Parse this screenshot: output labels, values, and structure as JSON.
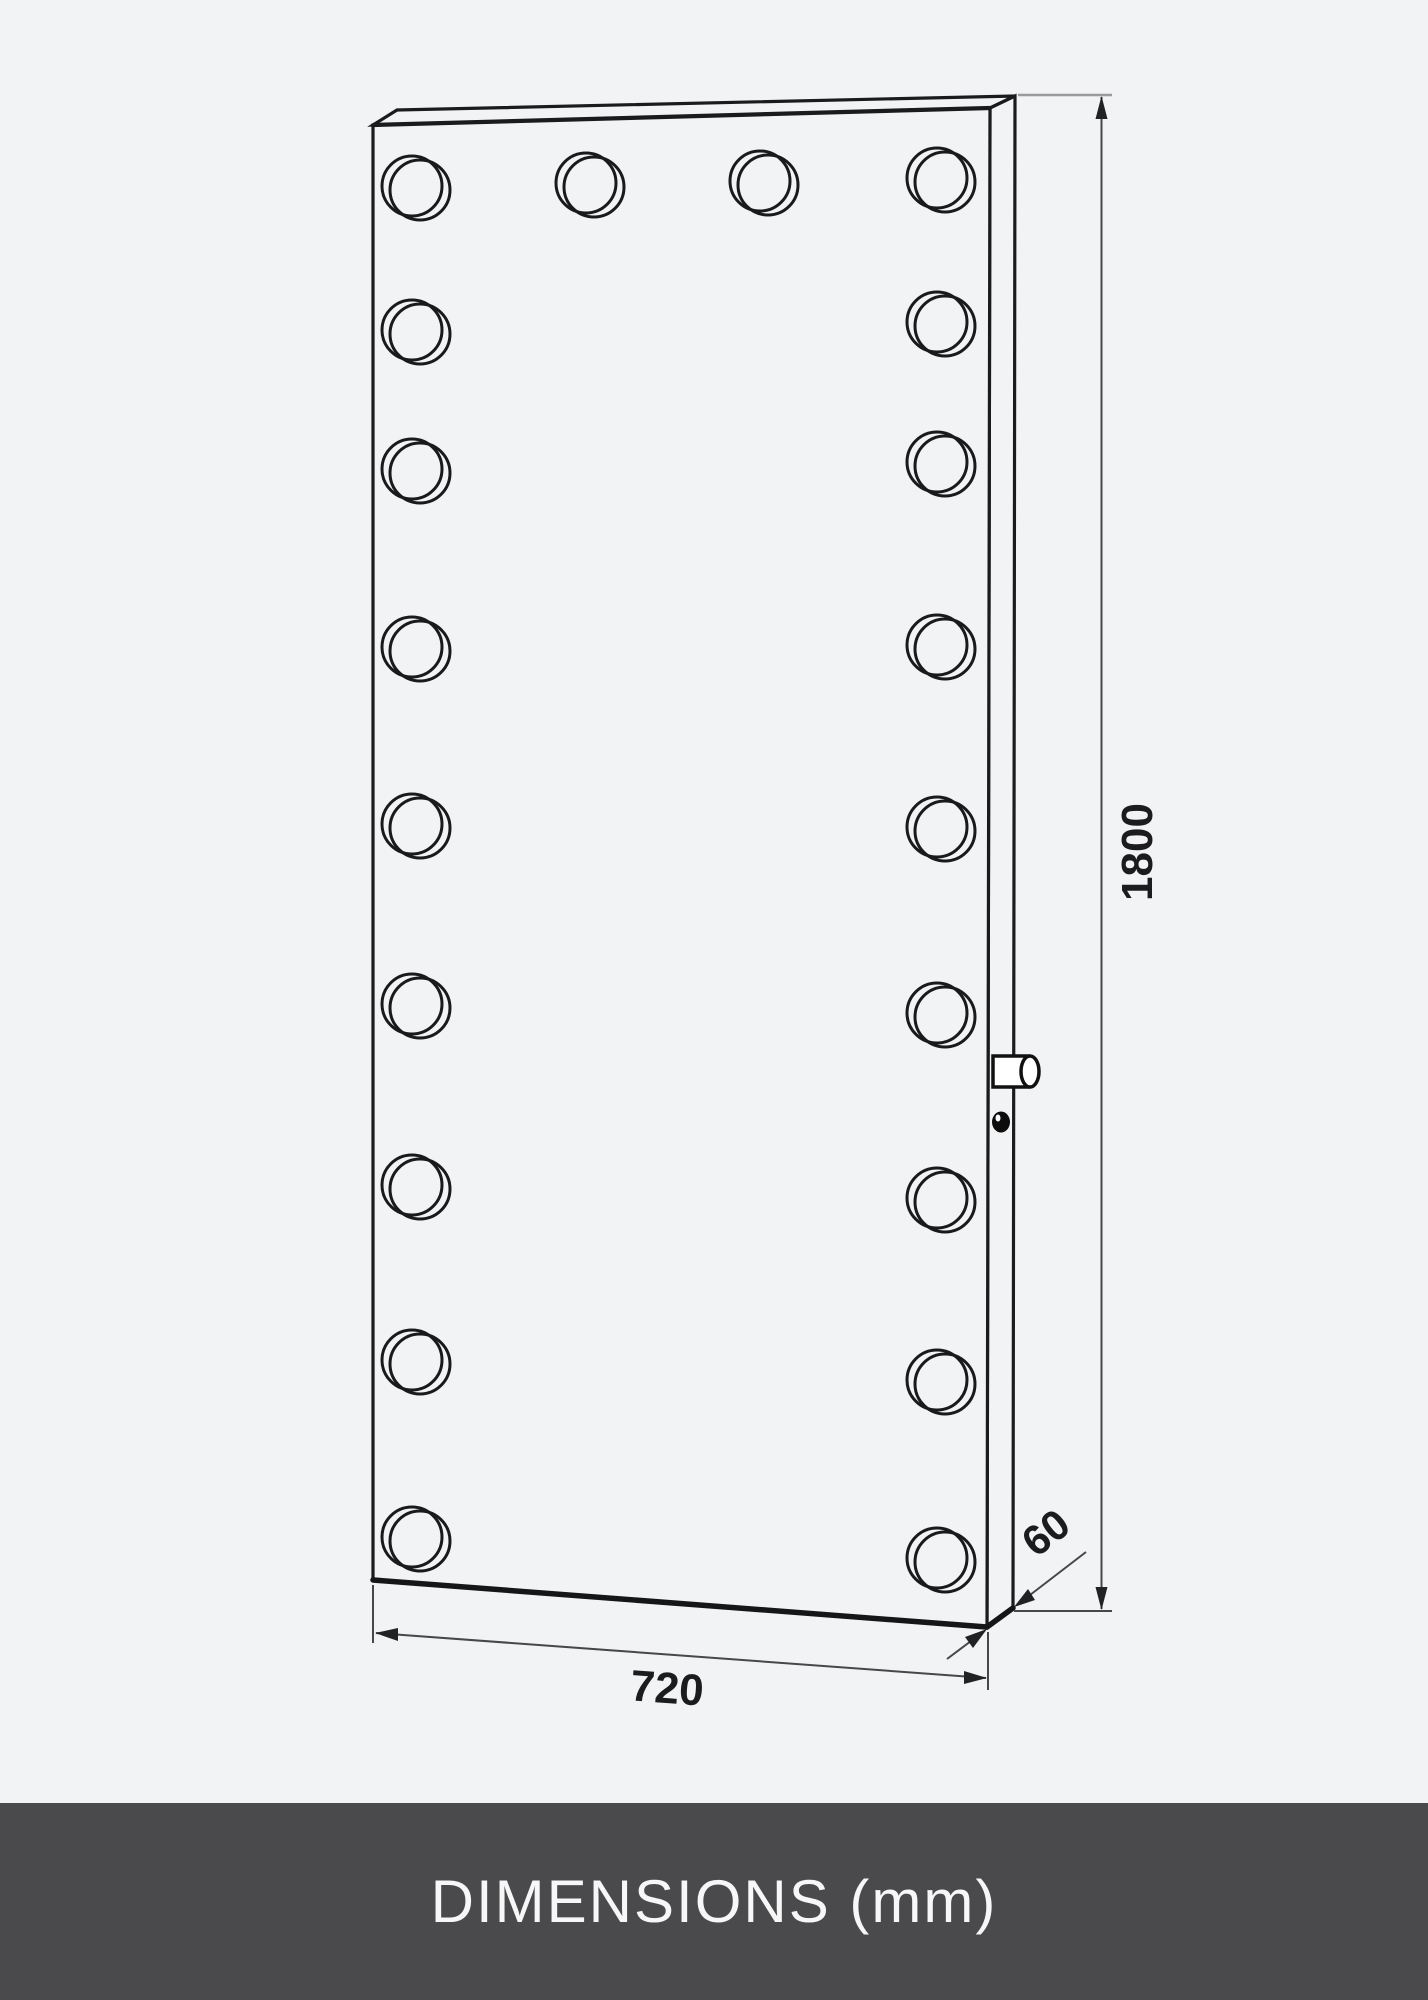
{
  "drawing": {
    "type": "technical-dimension-diagram",
    "object": "full-length hollywood mirror with light bulbs",
    "bulb_count": 20,
    "background_color": "#f2f3f5",
    "line_color": "#1b1b1b",
    "dimension_line_color": "#474747"
  },
  "dimensions": {
    "unit": "mm",
    "height": {
      "value": "1800"
    },
    "width": {
      "value": "720"
    },
    "depth": {
      "value": "60"
    }
  },
  "footer": {
    "label": "DIMENSIONS (mm)",
    "background_color": "#4a4a4c",
    "text_color": "#f7f7f7"
  }
}
